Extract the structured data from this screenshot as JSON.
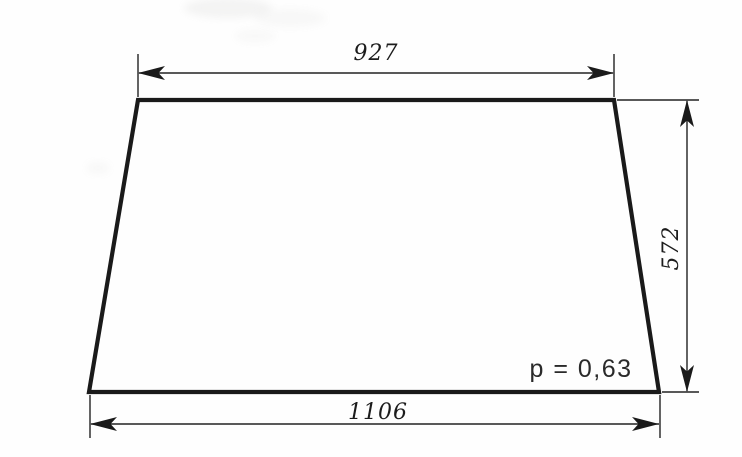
{
  "drawing": {
    "title": "trapezoid panel dimension drawing",
    "dimensions": {
      "top": "927",
      "bottom": "1106",
      "right": "572"
    },
    "annotation": "p = 0,63",
    "colors": {
      "paper": "#fefefe",
      "outline_ink": "#1a1a1a",
      "dimension_ink": "#222222",
      "text_ink": "#1c1c1c"
    }
  }
}
